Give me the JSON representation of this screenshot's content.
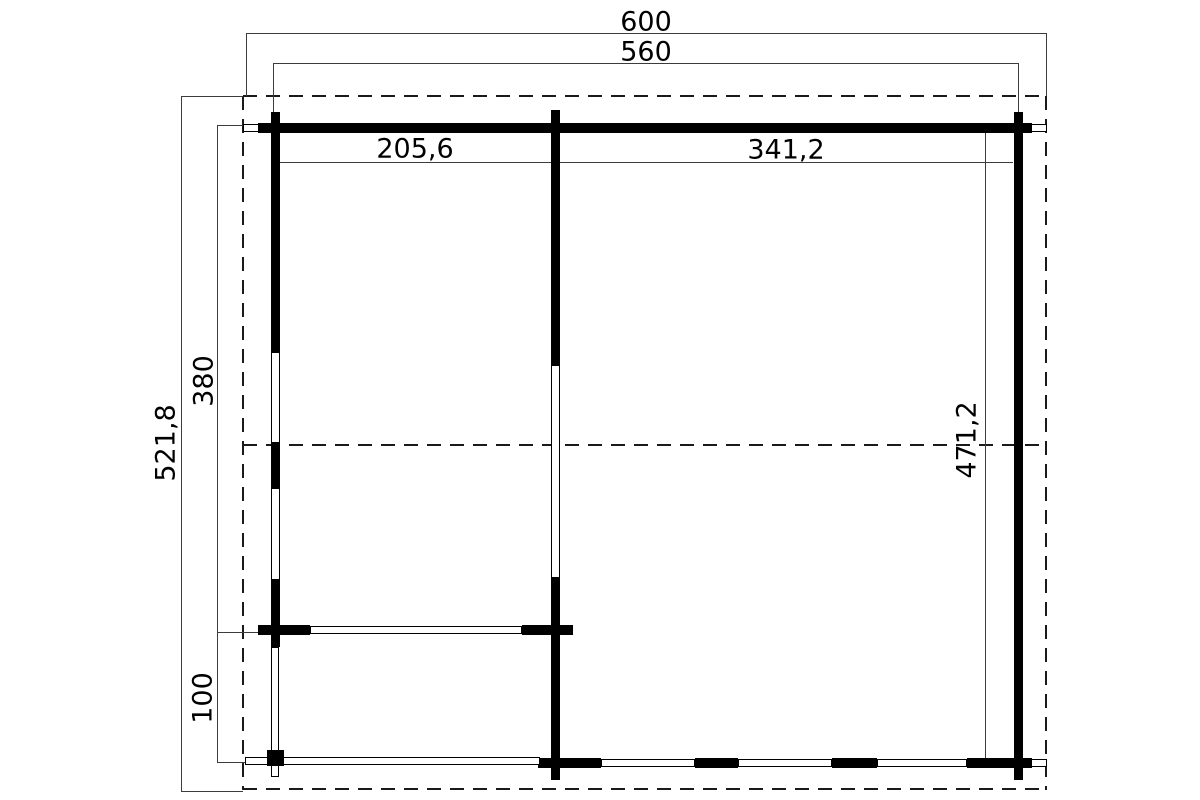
{
  "drawing": {
    "title": "floor-plan",
    "dimensions_top": {
      "overall_width": "600",
      "frame_width": "560"
    },
    "dimensions_rooms": {
      "left_room_width": "205,6",
      "right_room_width": "341,2"
    },
    "dimensions_left": {
      "total_depth": "521,8",
      "main_depth": "380",
      "veranda_depth": "100"
    },
    "dimensions_interior": {
      "room_depth": "471,2"
    }
  },
  "colors": {
    "wall": "#000000",
    "dimension_line": "#3c3c3c",
    "dashed_outline": "#1a1a1a",
    "background": "#ffffff"
  }
}
